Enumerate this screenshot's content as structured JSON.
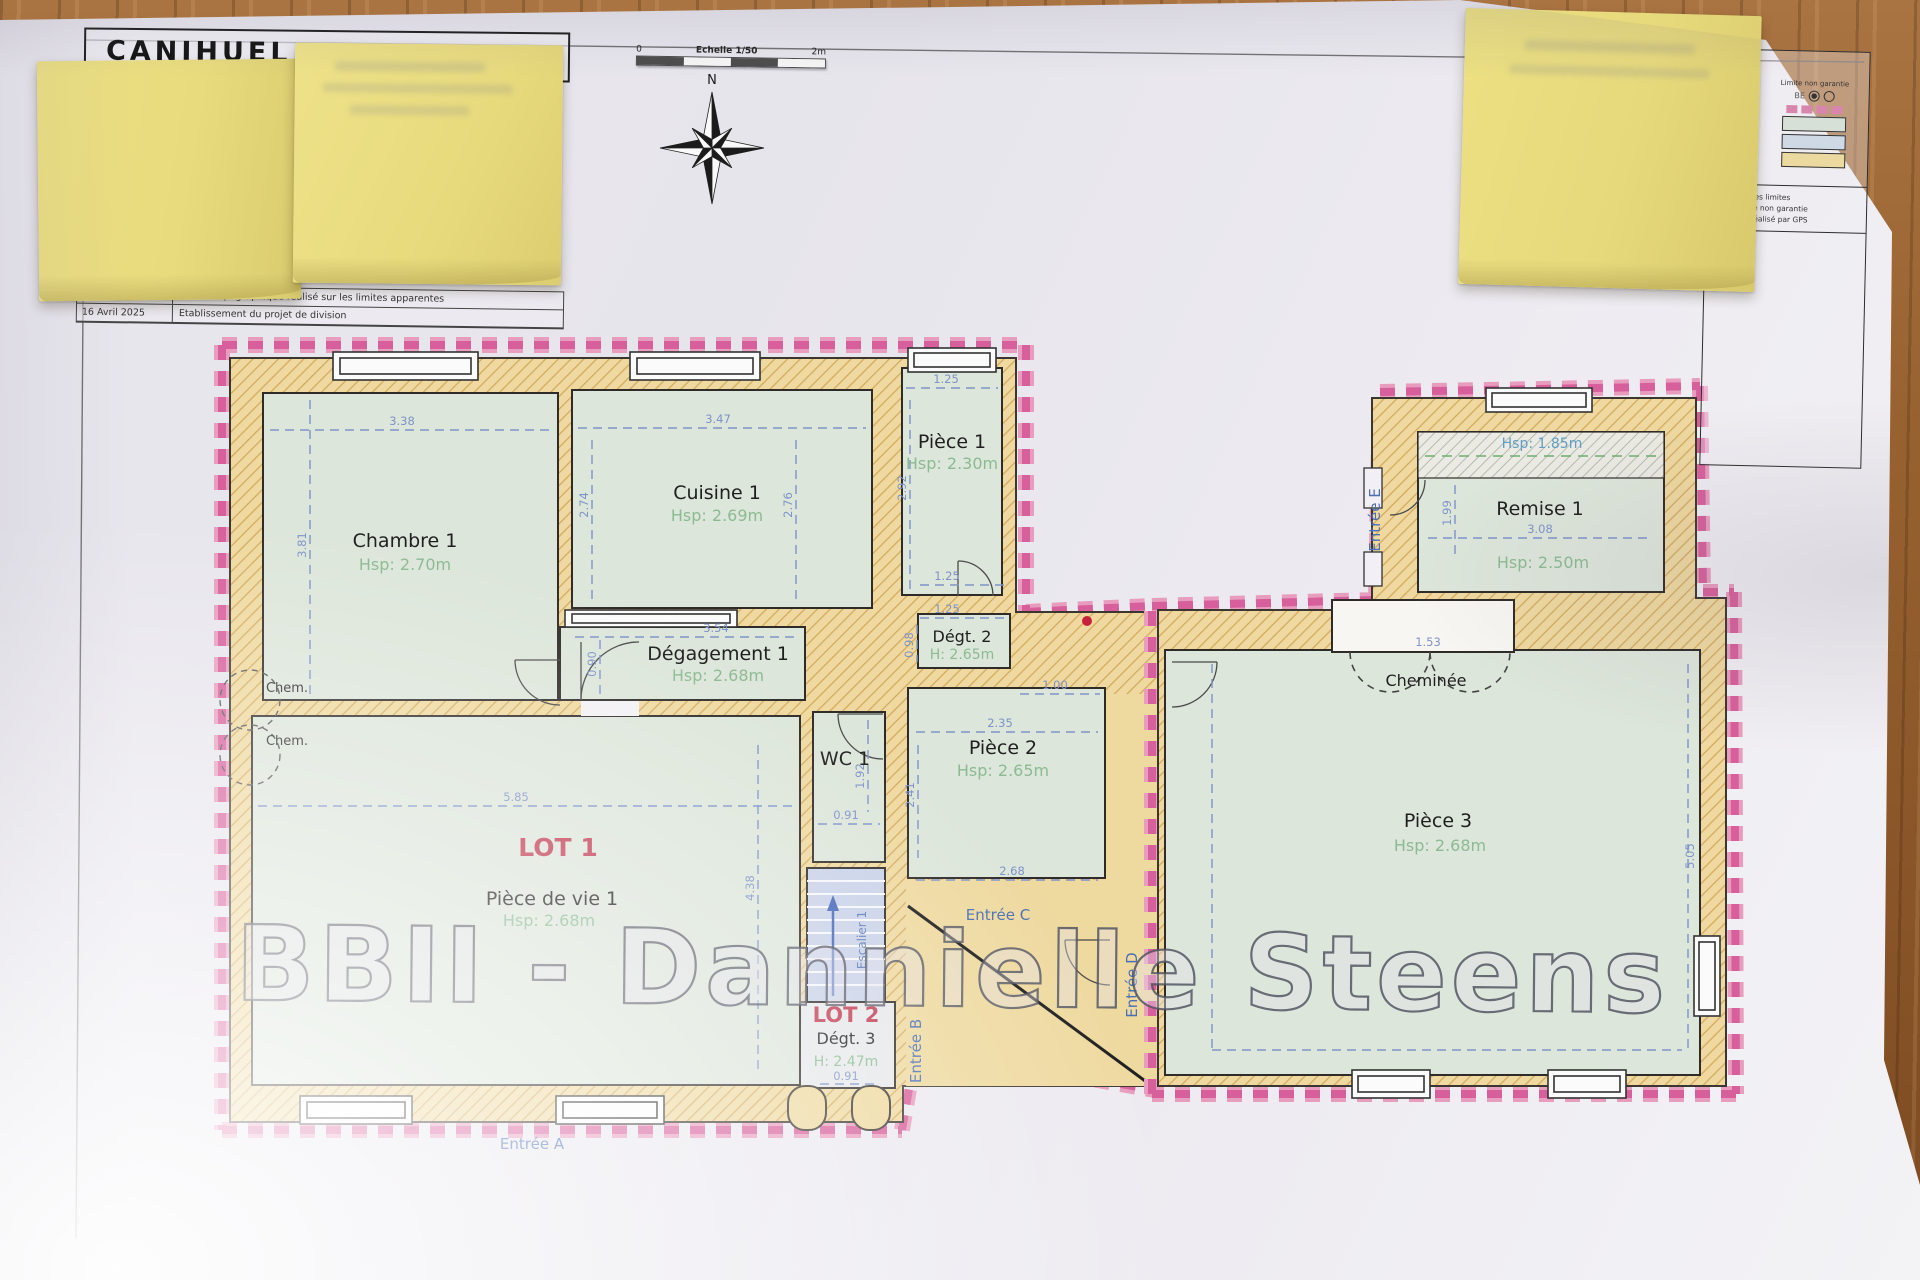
{
  "sheet": {
    "title": "CANIHUEL"
  },
  "revisions": [
    {
      "date": "Avril 2025",
      "desc": "Relevé topographique réalisé sur les limites apparentes"
    },
    {
      "date": "16 Avril 2025",
      "desc": "Etablissement du projet de division"
    }
  ],
  "scalebar": {
    "zero": "0",
    "label": "Echelle 1/50",
    "end": "2m"
  },
  "compass": {
    "n": "N"
  },
  "legend": {
    "left_lines": {
      "l1": "ais",
      "l2": "cadastral",
      "l3": "existants",
      "l4": "propriété"
    },
    "limit_note": "Limite non garantie",
    "marker": "BE",
    "notes": {
      "n1": "2025, sur les limites",
      "n2": "mite fiscale non garantie",
      "n3": "métrique réalisé par GPS"
    }
  },
  "watermark": "BBII - Dannielle Steens",
  "lots": {
    "lot1": "LOT 1",
    "lot2": "LOT 2"
  },
  "rooms": {
    "chambre1": {
      "name": "Chambre 1",
      "h": "Hsp: 2.70m"
    },
    "cuisine1": {
      "name": "Cuisine 1",
      "h": "Hsp: 2.69m"
    },
    "piece1": {
      "name": "Pièce 1",
      "h": "Hsp: 2.30m"
    },
    "degagement1": {
      "name": "Dégagement 1",
      "h": "Hsp: 2.68m"
    },
    "degt2": {
      "name": "Dégt. 2",
      "h": "H: 2.65m"
    },
    "wc1": {
      "name": "WC 1"
    },
    "piece2": {
      "name": "Pièce 2",
      "h": "Hsp: 2.65m"
    },
    "pdv1": {
      "name": "Pièce de vie 1",
      "h": "Hsp: 2.68m"
    },
    "degt3": {
      "name": "Dégt. 3",
      "h": "H: 2.47m"
    },
    "piece3": {
      "name": "Pièce 3",
      "h": "Hsp: 2.68m"
    },
    "remise1": {
      "name": "Remise 1",
      "h": "Hsp: 2.50m",
      "upper_h": "Hsp: 1.85m"
    },
    "escalier1": "Escalier 1",
    "cheminee": "Cheminée",
    "chem": "Chem."
  },
  "entrances": {
    "a": "Entrée A",
    "b": "Entrée B",
    "c": "Entrée C",
    "d": "Entrée D",
    "e": "Entrée E"
  },
  "dims": {
    "chambre_w": "3.38",
    "chambre_h": "3.81",
    "cuisine_w": "3.47",
    "cuisine_hl": "2.74",
    "cuisine_hr": "2.76",
    "p1_w": "1.25",
    "p1_h": "2.92",
    "degt2_w1": "1.25",
    "degt2_w2": "1.25",
    "degt2_h": "0.98",
    "corridor_w": "3.54",
    "corridor_h": "0.90",
    "wc_w": "0.91",
    "wc_h": "1.92",
    "p2_w1": "1.00",
    "p2_w2": "2.35",
    "p2_h": "2.41",
    "p2_w3": "2.68",
    "pdv_w": "5.85",
    "pdv_h": "4.38",
    "degt3_w": "0.91",
    "remise_w": "3.08",
    "remise_h": "1.99",
    "p3_a": "1.53",
    "p3_h": "5.05"
  },
  "colors": {
    "boundary": "#de74a6",
    "wall": "#efdaa1",
    "room": "#dde6db",
    "dim": "#7e93c8",
    "height_text": "#8cba92",
    "lot": "#c23b52",
    "entrance": "#4a6fb5"
  }
}
